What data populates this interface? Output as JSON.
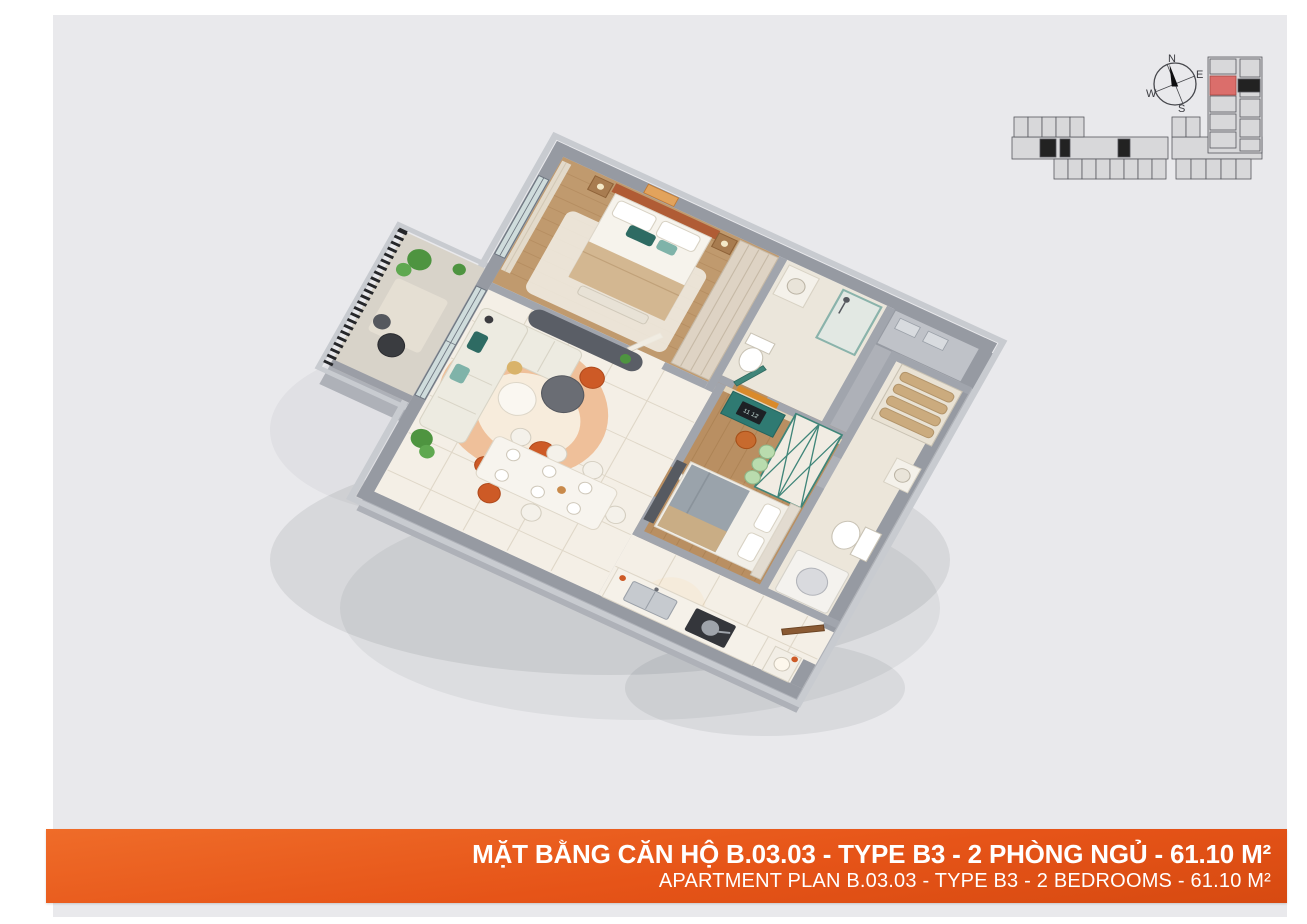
{
  "page": {
    "background": "#ffffff",
    "panel": "#e9e9ec"
  },
  "banner": {
    "title": "MẶT BẰNG CĂN HỘ B.03.03 - TYPE B3 - 2 PHÒNG NGỦ - 61.10 M²",
    "subtitle": "APARTMENT PLAN B.03.03 - TYPE B3 - 2 BEDROOMS - 61.10 M²",
    "accent_color": "#e65418",
    "text_color": "#ffffff"
  },
  "compass": {
    "n": "N",
    "e": "E",
    "s": "S",
    "w": "W"
  },
  "key_plan": {
    "highlight_color": "#db6e6b",
    "unit_fill": "#d8d8da",
    "outline_color": "#56575d",
    "core_color": "#222222"
  },
  "apartment": {
    "clock_display": "11 12",
    "palette": {
      "wall_exterior": "#969aa2",
      "wall_interior": "#a1a5ad",
      "wood_floor": "#c09a6e",
      "marble_floor": "#f4efe6",
      "bath_floor": "#ebe6db",
      "accent_orange": "#cd5a26",
      "accent_teal": "#2e6b63",
      "wardrobe_teal": "#3f8579",
      "sofa": "#edebe1",
      "railing": "#26272a",
      "entry_door_wood": "#8a5a33"
    }
  }
}
